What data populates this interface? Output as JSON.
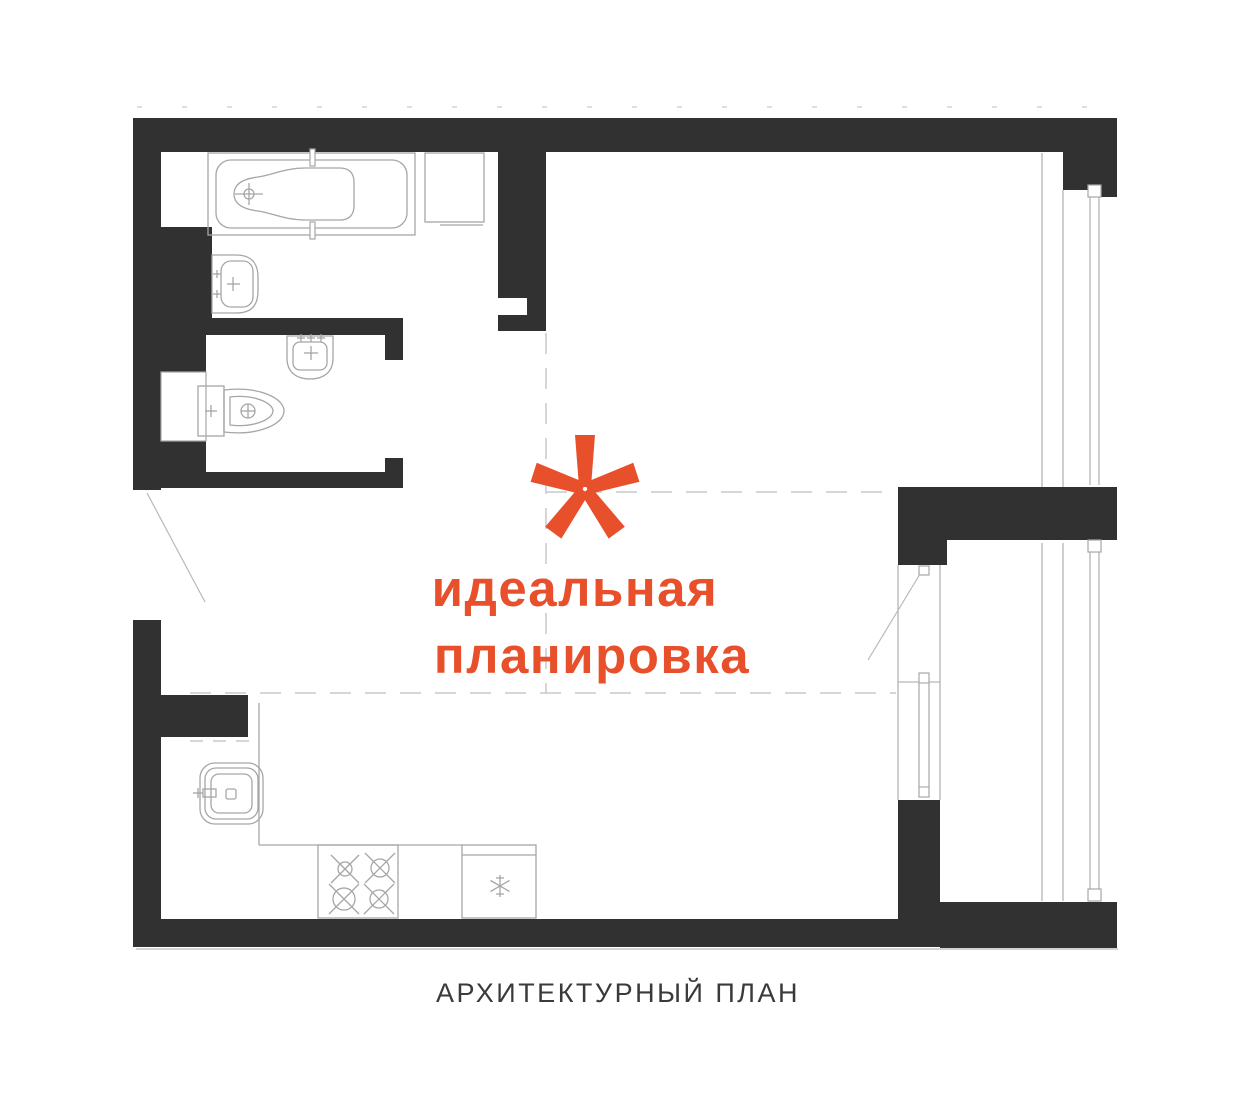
{
  "page": {
    "background": "#ffffff",
    "kind": "architectural floor plan"
  },
  "colors": {
    "wall": "#313131",
    "fixture_line": "#a6a6a6",
    "dashed_line": "#c9c9c9",
    "accent": "#e8502b",
    "caption_text": "#3a3a3a"
  },
  "annotation": {
    "asterisk_icon": "asterisk-5-spoke",
    "line1": "идеальная",
    "line2": "планировка"
  },
  "caption": {
    "label": "АРХИТЕКТУРНЫЙ ПЛАН"
  },
  "fixtures": [
    "bathtub",
    "washing-machine",
    "bathroom-sink",
    "wc-sink",
    "toilet",
    "kitchen-sink",
    "stove-4-burners",
    "refrigerator-snowflake",
    "entrance-door-swing",
    "balcony-door-swing",
    "window-upper",
    "window-lower",
    "wall-niche"
  ]
}
